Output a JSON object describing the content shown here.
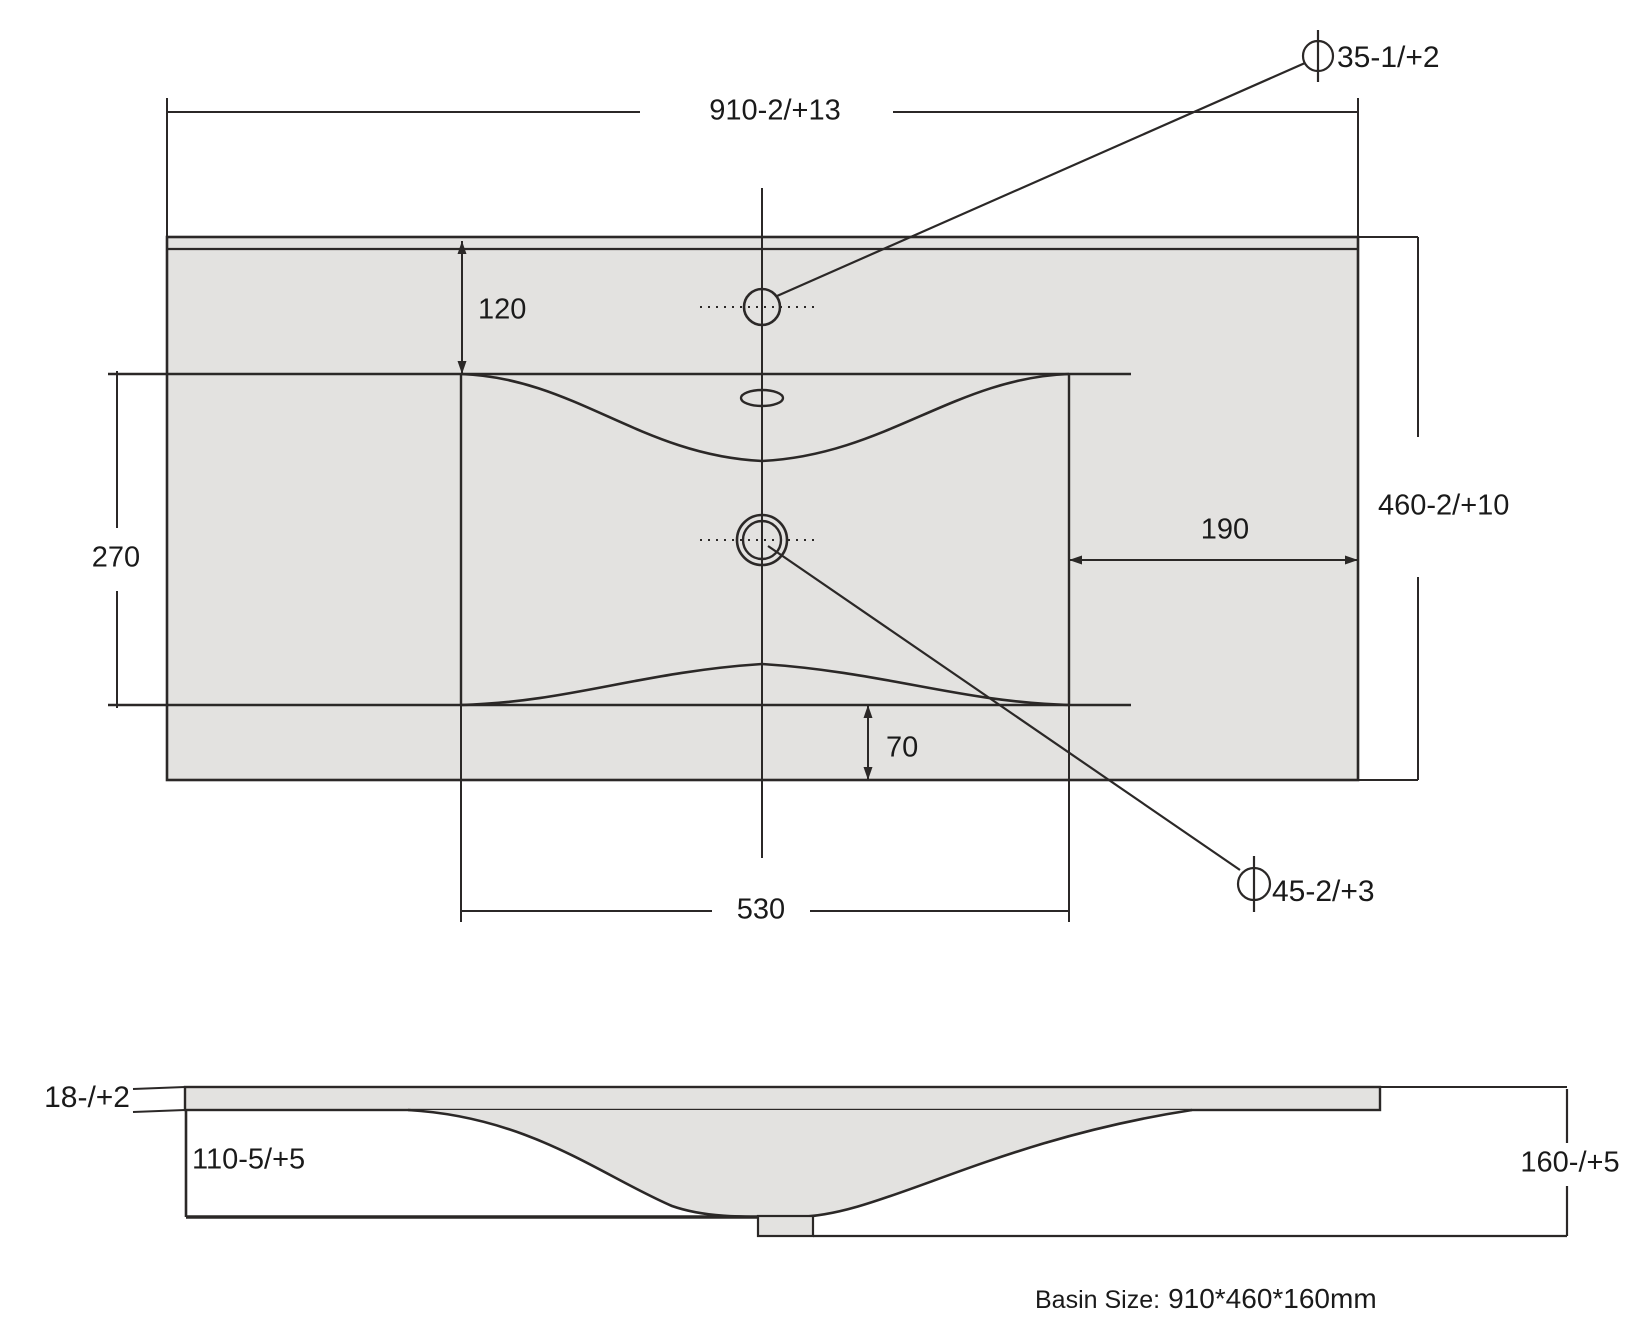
{
  "colors": {
    "surface_fill": "#e3e2e0",
    "line": "#2b2827",
    "text": "#1a1a1a",
    "background": "#ffffff"
  },
  "top_view": {
    "width_dim": "910-2/+13",
    "depth_dim": "460-2/+10",
    "faucet_offset_dim": "120",
    "inner_basin_depth_dim": "270",
    "drain_right_offset_dim": "190",
    "inner_basin_width_dim": "530",
    "bottom_offset_dim": "70",
    "faucet_hole_dia_dim": "35-1/+2",
    "drain_hole_dia_dim": "45-2/+3"
  },
  "side_view": {
    "top_thickness_dim": "18-/+2",
    "front_height_dim": "110-5/+5",
    "overall_height_dim": "160-/+5"
  },
  "footer": {
    "label": "Basin Size:",
    "value": "910*460*160mm"
  }
}
